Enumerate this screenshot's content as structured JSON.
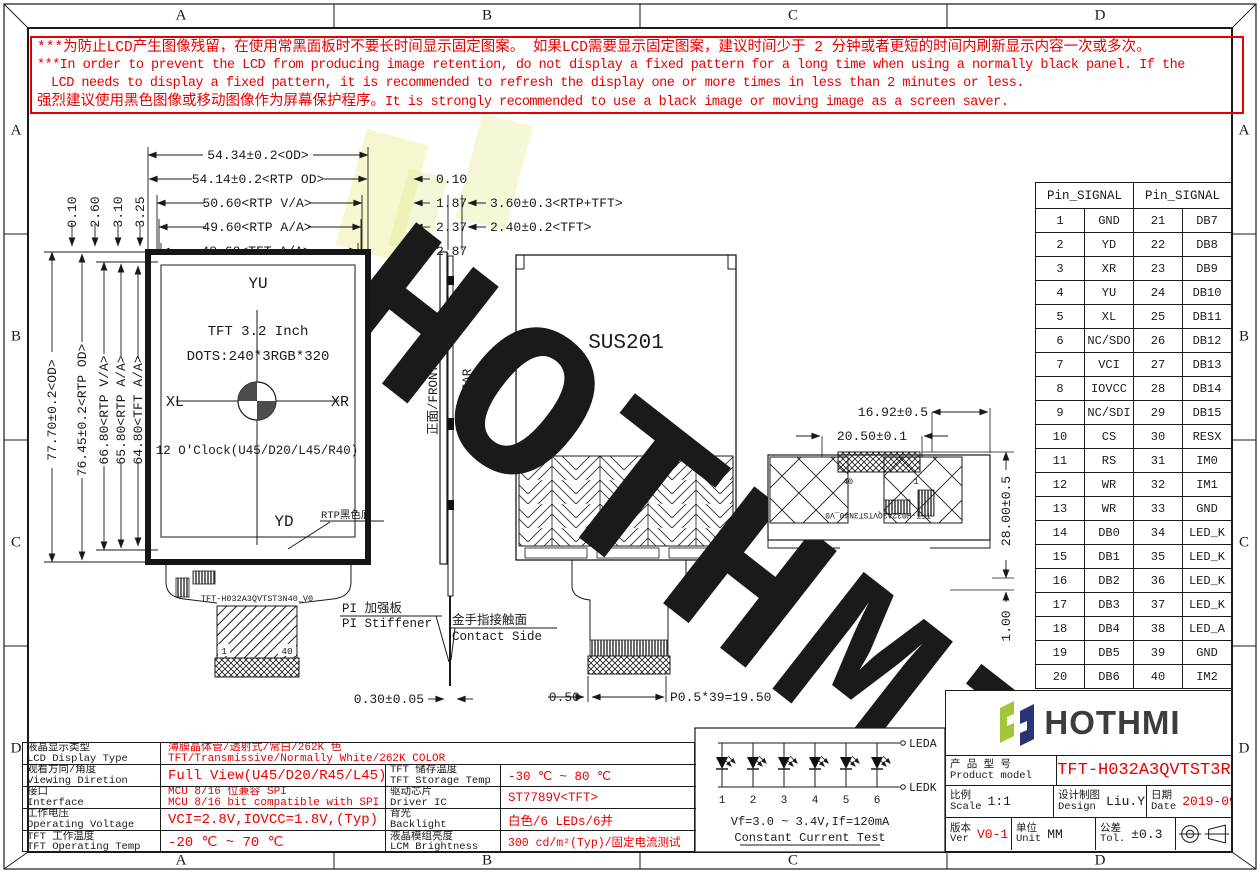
{
  "colors": {
    "red": "#e80000",
    "line": "#1a1a1a",
    "logo_green": "#a3c53a",
    "logo_navy": "#283477"
  },
  "ruler": {
    "top": [
      "A",
      "B",
      "C",
      "D"
    ],
    "bottom": [
      "A",
      "B",
      "C",
      "D"
    ],
    "left": [
      "A",
      "B",
      "C",
      "D"
    ],
    "right": [
      "A",
      "B",
      "C",
      "D"
    ]
  },
  "warning": {
    "line1": "***为防止LCD产生图像残留，在使用常黑面板时不要长时间显示固定图案。 如果LCD需要显示固定图案，建议时间少于 2 分钟或者更短的时间内刷新显示内容一次或多次。",
    "line2": "***In order to prevent the LCD from producing image retention, do not display a fixed pattern for a long time when using a normally black panel. If the",
    "line3": "LCD needs to display a fixed pattern, it is recommended to refresh the display one or more times in less than 2 minutes or less.",
    "line4_cn": "强烈建议使用黑色图像或移动图像作为屏幕保护程序。",
    "line4_en": "It is strongly recommended to use a black image or moving image as a screen saver."
  },
  "front_view": {
    "top_dims": [
      "54.34±0.2<OD>",
      "54.14±0.2<RTP OD>",
      "50.60<RTP V/A>",
      "49.60<RTP A/A>",
      "48.60<TFT A/A>"
    ],
    "right_offsets": [
      "0.10",
      "1.87",
      "2.37",
      "2.87"
    ],
    "right_dims": [
      "3.60±0.3<RTP+TFT>",
      "2.40±0.2<TFT>"
    ],
    "left_dims": [
      "77.70±0.2<OD>",
      "76.45±0.2<RTP OD>",
      "66.80<RTP V/A>",
      "65.80<RTP A/A>",
      "64.80<TFT A/A>"
    ],
    "top_offsets": [
      "0.10",
      "2.60",
      "3.10",
      "3.25"
    ],
    "yu": "YU",
    "yd": "YD",
    "xl": "XL",
    "xr": "XR",
    "size_label": "TFT 3.2 Inch",
    "dots_label": "DOTS:240*3RGB*320",
    "clock_label": "12 O'Clock(U45/D20/L45/R40)",
    "rtp_note": "RTP黑色底",
    "fpc_label": "TFT-H032A3QVTST3N40_V0",
    "pin_first": "1",
    "pin_last": "40"
  },
  "side_view": {
    "front_label": "正面/FRONT",
    "rear_label": "背面/REAR",
    "thickness": "0.30±0.05",
    "stiffener_cn": "PI 加强板",
    "stiffener_en": "PI Stiffener",
    "contact_cn": "金手指接触面",
    "contact_en": "Contact Side"
  },
  "rear_view": {
    "material": "SUS201",
    "offset": "0.50",
    "pitch": "P0.5*39=19.50"
  },
  "rear_detail": {
    "dim_a": "16.92±0.5",
    "dim_b": "20.50±0.1",
    "dim_c": "28.00±0.5",
    "dim_d": "1.00",
    "pin_last": "40",
    "pin_first": "1",
    "fpc_label": "TFT-H032A3QVTST3N40_V0"
  },
  "pin_table": {
    "header_left": "Pin_SIGNAL",
    "header_right": "Pin_SIGNAL",
    "rows": [
      [
        "1",
        "GND",
        "21",
        "DB7"
      ],
      [
        "2",
        "YD",
        "22",
        "DB8"
      ],
      [
        "3",
        "XR",
        "23",
        "DB9"
      ],
      [
        "4",
        "YU",
        "24",
        "DB10"
      ],
      [
        "5",
        "XL",
        "25",
        "DB11"
      ],
      [
        "6",
        "NC/SDO",
        "26",
        "DB12"
      ],
      [
        "7",
        "VCI",
        "27",
        "DB13"
      ],
      [
        "8",
        "IOVCC",
        "28",
        "DB14"
      ],
      [
        "9",
        "NC/SDI",
        "29",
        "DB15"
      ],
      [
        "10",
        "CS",
        "30",
        "RESX"
      ],
      [
        "11",
        "RS",
        "31",
        "IM0"
      ],
      [
        "12",
        "WR",
        "32",
        "IM1"
      ],
      [
        "13",
        "WR",
        "33",
        "GND"
      ],
      [
        "14",
        "DB0",
        "34",
        "LED_K"
      ],
      [
        "15",
        "DB1",
        "35",
        "LED_K"
      ],
      [
        "16",
        "DB2",
        "36",
        "LED_K"
      ],
      [
        "17",
        "DB3",
        "37",
        "LED_K"
      ],
      [
        "18",
        "DB4",
        "38",
        "LED_A"
      ],
      [
        "19",
        "DB5",
        "39",
        "GND"
      ],
      [
        "20",
        "DB6",
        "40",
        "IM2"
      ]
    ]
  },
  "spec_table": {
    "rows": [
      {
        "label_cn": "液晶显示类型",
        "label_en": "LCD Display Type",
        "value1": "薄膜晶体管/透射式/常白/262K 色",
        "value2": "TFT/Transmissive/Normally White/262K COLOR"
      },
      {
        "label_cn": "观看方向/角度",
        "label_en": "Viewing Diretion",
        "value1": "Full View(U45/D20/R45/L45)",
        "r_label_cn": "TFT 储存温度",
        "r_label_en": "TFT Storage Temp",
        "r_value": "-30 ℃ ~ 80 ℃"
      },
      {
        "label_cn": "接口",
        "label_en": "Interface",
        "value1": "MCU 8/16 位兼容 SPI",
        "value2": "MCU 8/16 bit compatible with SPI",
        "r_label_cn": "驱动芯片",
        "r_label_en": "Driver IC",
        "r_value": "ST7789V<TFT>"
      },
      {
        "label_cn": "工作电压",
        "label_en": "Operating Voltage",
        "value1": "VCI=2.8V,IOVCC=1.8V,(Typ)",
        "r_label_cn": "背光",
        "r_label_en": "Backlight",
        "r_value": "白色/6 LEDs/6并"
      },
      {
        "label_cn": "TFT 工作温度",
        "label_en": "TFT Operating Temp",
        "value1": "-20 ℃ ~ 70 ℃",
        "r_label_cn": "液晶模组亮度",
        "r_label_en": "LCM Brightness",
        "r_value": "300 cd/m²(Typ)/固定电流测试"
      }
    ]
  },
  "led_box": {
    "terminal_a": "LEDA",
    "terminal_k": "LEDK",
    "numbers": [
      "1",
      "2",
      "3",
      "4",
      "5",
      "6"
    ],
    "spec": "Vf=3.0 ~ 3.4V,If=120mA",
    "test": "Constant Current Test"
  },
  "title_block": {
    "brand": "HOTHMI",
    "model_label_cn": "产 品 型 号",
    "model_label_en": "Product model",
    "model": "TFT-H032A3QVTST3R40",
    "scale_cn": "比例",
    "scale_en": "Scale",
    "scale_value": "1:1",
    "design_cn": "设计制图",
    "design_en": "Design",
    "design_value": "Liu.YL",
    "date_cn": "日期",
    "date_en": "Date",
    "date_value": "2019-09-12",
    "ver_cn": "版本",
    "ver_en": "Ver",
    "ver_value": "V0-1",
    "unit_cn": "单位",
    "unit_en": "Unit",
    "unit_value": "MM",
    "tol_cn": "公差",
    "tol_en": "Tol.",
    "tol_value": "±0.3"
  },
  "watermark": {
    "text": "HOTHMI"
  }
}
